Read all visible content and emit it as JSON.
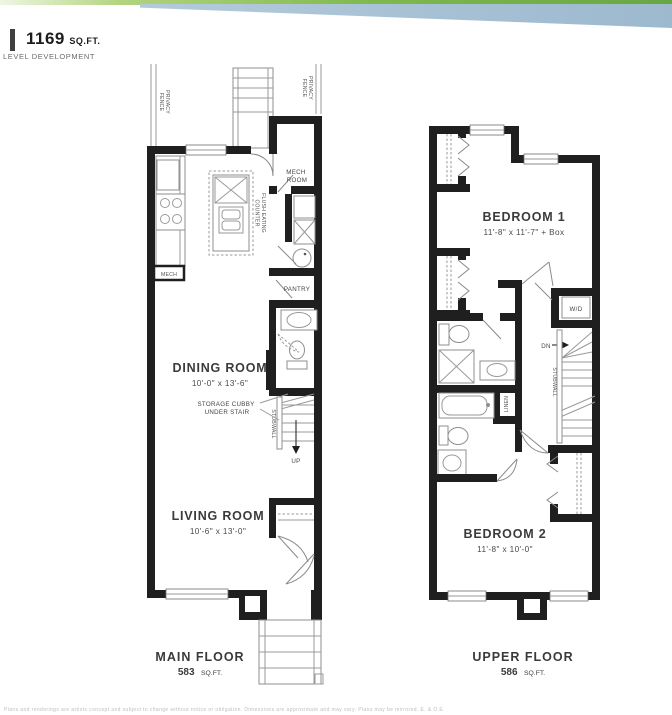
{
  "header": {
    "area_value": "1169",
    "area_unit": "SQ.FT.",
    "company": "LEVEL DEVELOPMENT"
  },
  "main_floor": {
    "title": "MAIN FLOOR",
    "area_value": "583",
    "area_unit": "SQ.FT.",
    "rooms": {
      "dining": {
        "name": "DINING ROOM",
        "dims": "10'-0\" x 13'-6\""
      },
      "living": {
        "name": "LIVING ROOM",
        "dims": "10'-6\" x 13'-0\""
      },
      "mech_room_line1": "MECH",
      "mech_room_line2": "ROOM",
      "pantry": "PANTRY"
    },
    "labels": {
      "privacy_fence_line1": "PRIVACY",
      "privacy_fence_line2": "FENCE",
      "flush_line1": "FLUSH EATING",
      "flush_line2": "COUNTER",
      "mech_box": "MECH",
      "storage_line1": "STORAGE CUBBY",
      "storage_line2": "UNDER STAIR",
      "stubwall": "STUBWALL",
      "up": "UP"
    }
  },
  "upper_floor": {
    "title": "UPPER FLOOR",
    "area_value": "586",
    "area_unit": "SQ.FT.",
    "rooms": {
      "bedroom1": {
        "name": "BEDROOM 1",
        "dims": "11'-8\" x 11'-7\" + Box"
      },
      "bedroom2": {
        "name": "BEDROOM 2",
        "dims": "11'-8\" x 10'-0\""
      }
    },
    "labels": {
      "wd": "W/D",
      "dn": "DN",
      "linen": "LINEN",
      "stubwall": "STUBWALL"
    }
  },
  "footer": {
    "disclaimer": "Plans and renderings are artists concept and subject to change without notice or obligation. Dimensions are approximate and may vary. Plans may be mirrored. E. & O.E."
  },
  "colors": {
    "banner_green": "#7fb94e",
    "banner_blue": "#a6c0d3",
    "wall": "#1f1f1f",
    "line": "#9a9a9a",
    "text": "#3b3b3b"
  }
}
